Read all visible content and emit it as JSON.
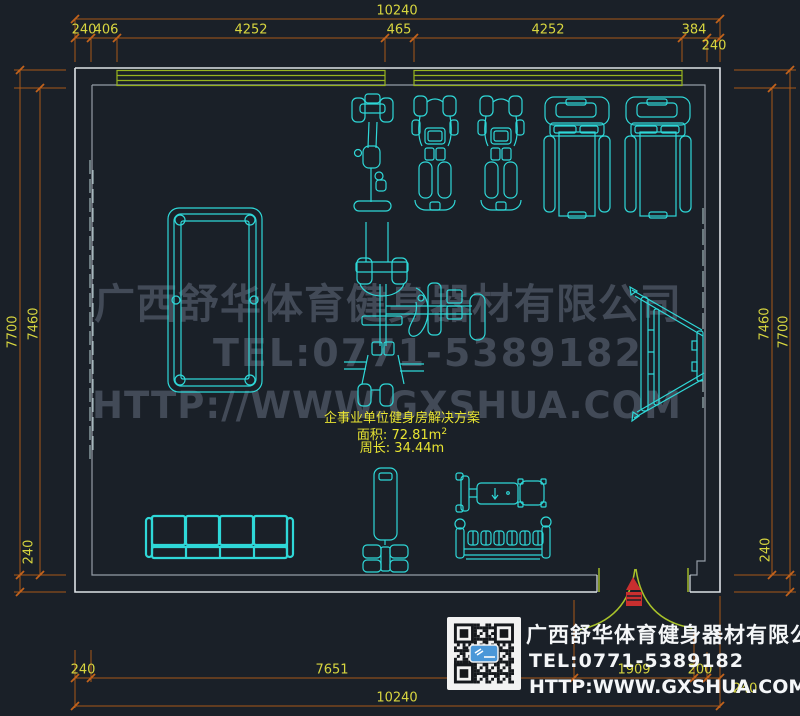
{
  "colors": {
    "background": "#1a2028",
    "dimension_line": "#a85818",
    "dimension_text": "#d8d63f",
    "wall_outer": "#dde2e6",
    "wall_inner": "#959da6",
    "equipment": "#2fd8d8",
    "window_green": "#97b41f",
    "door_arc": "#a9c32a",
    "door_marker_red": "#c92f2f",
    "watermark_gray": "#4a5260",
    "label_yellow": "#e8e432",
    "card_text_white": "#f4f6f8"
  },
  "dimensions": {
    "top_overall": "10240",
    "top_segments": [
      "240",
      "406",
      "4252",
      "465",
      "4252",
      "384"
    ],
    "top_right_wall": "240",
    "left_outer": "7700",
    "left_inner": "7460",
    "left_bottom": "240",
    "right_inner": "7460",
    "right_outer": "7700",
    "right_bottom": "240",
    "bottom_row1": [
      "240",
      "7651",
      "1909",
      "200"
    ],
    "bottom_right_wall": "240",
    "bottom_overall": "10240"
  },
  "plan_info": {
    "title": "企事业单位健身房解决方案",
    "area_label": "面积: 72.81m",
    "area_sup": "2",
    "perimeter_label": "周长: 34.44m"
  },
  "watermark": {
    "line1": "广西舒华体育健身器材有限公司",
    "line2": "TEL:0771-5389182",
    "line3": "HTTP://WWW.GXSHUA.COM"
  },
  "company_card": {
    "name": "广西舒华体育健身器材有限公司",
    "tel": "TEL:0771-5389182",
    "website": "HTTP:WWW.GXSHUA.COM"
  },
  "equipment": {
    "items": [
      "exercise-bike",
      "strength-machine",
      "strength-machine",
      "treadmill",
      "treadmill",
      "billiard-table",
      "multi-station-gym",
      "situp-board",
      "sofa-4-seat",
      "heavy-bag-stand",
      "weight-bench",
      "dumbbell-rack",
      "wall-mirror",
      "double-door"
    ]
  }
}
